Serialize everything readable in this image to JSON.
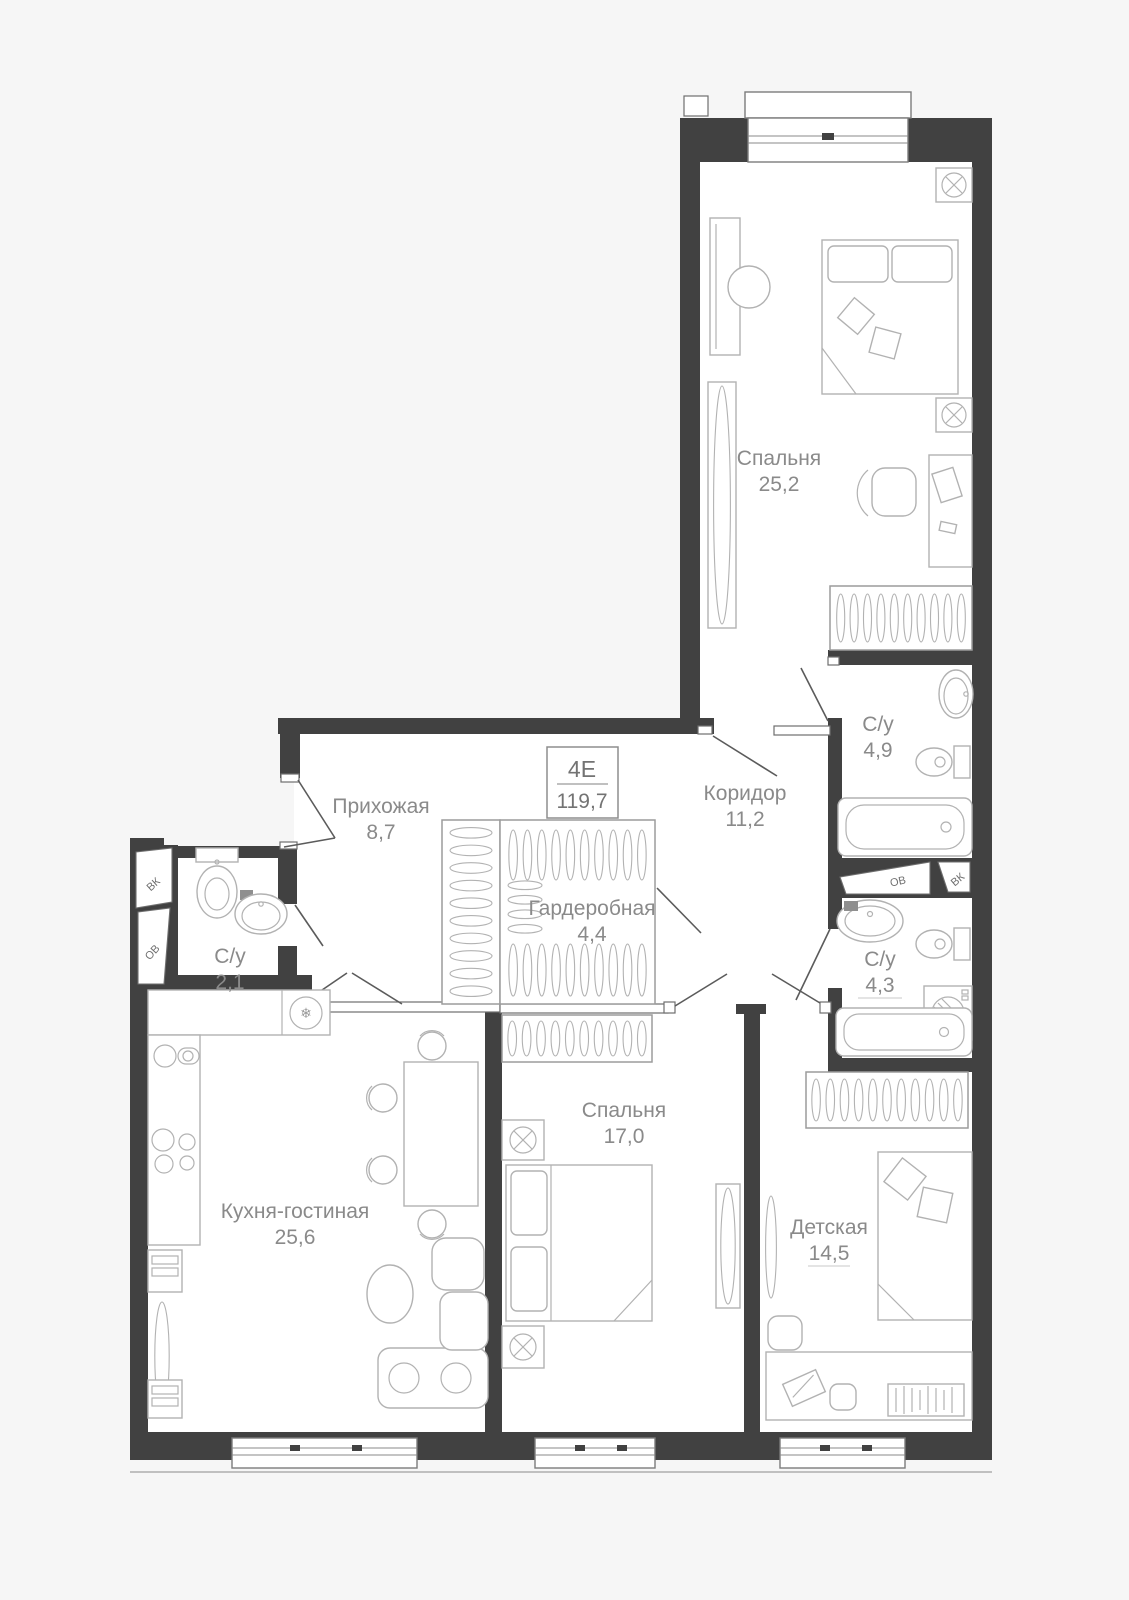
{
  "plan": {
    "unit_box": {
      "type_label": "4Е",
      "total_area": "119,7"
    },
    "rooms": {
      "bedroom1": {
        "name": "Спальня",
        "area": "25,2"
      },
      "corridor": {
        "name": "Коридор",
        "area": "11,2"
      },
      "hallway": {
        "name": "Прихожая",
        "area": "8,7"
      },
      "wardrobe": {
        "name": "Гардеробная",
        "area": "4,4"
      },
      "bath1": {
        "name": "С/у",
        "area": "4,9"
      },
      "bath2": {
        "name": "С/у",
        "area": "4,3"
      },
      "bath3": {
        "name": "С/у",
        "area": "2,1"
      },
      "kitchen": {
        "name": "Кухня-гостиная",
        "area": "25,6"
      },
      "bedroom2": {
        "name": "Спальня",
        "area": "17,0"
      },
      "kids": {
        "name": "Детская",
        "area": "14,5"
      }
    },
    "shafts": {
      "vk_left": "ВК",
      "ov_left": "ОВ",
      "ov_right": "ОВ",
      "vk_right": "ВК"
    },
    "icons": {
      "snowflake": "❄"
    },
    "colors": {
      "wall": "#414141",
      "furniture": "#b2b2b2",
      "label_text": "#8a8a8a",
      "background": "#f6f6f6"
    }
  }
}
